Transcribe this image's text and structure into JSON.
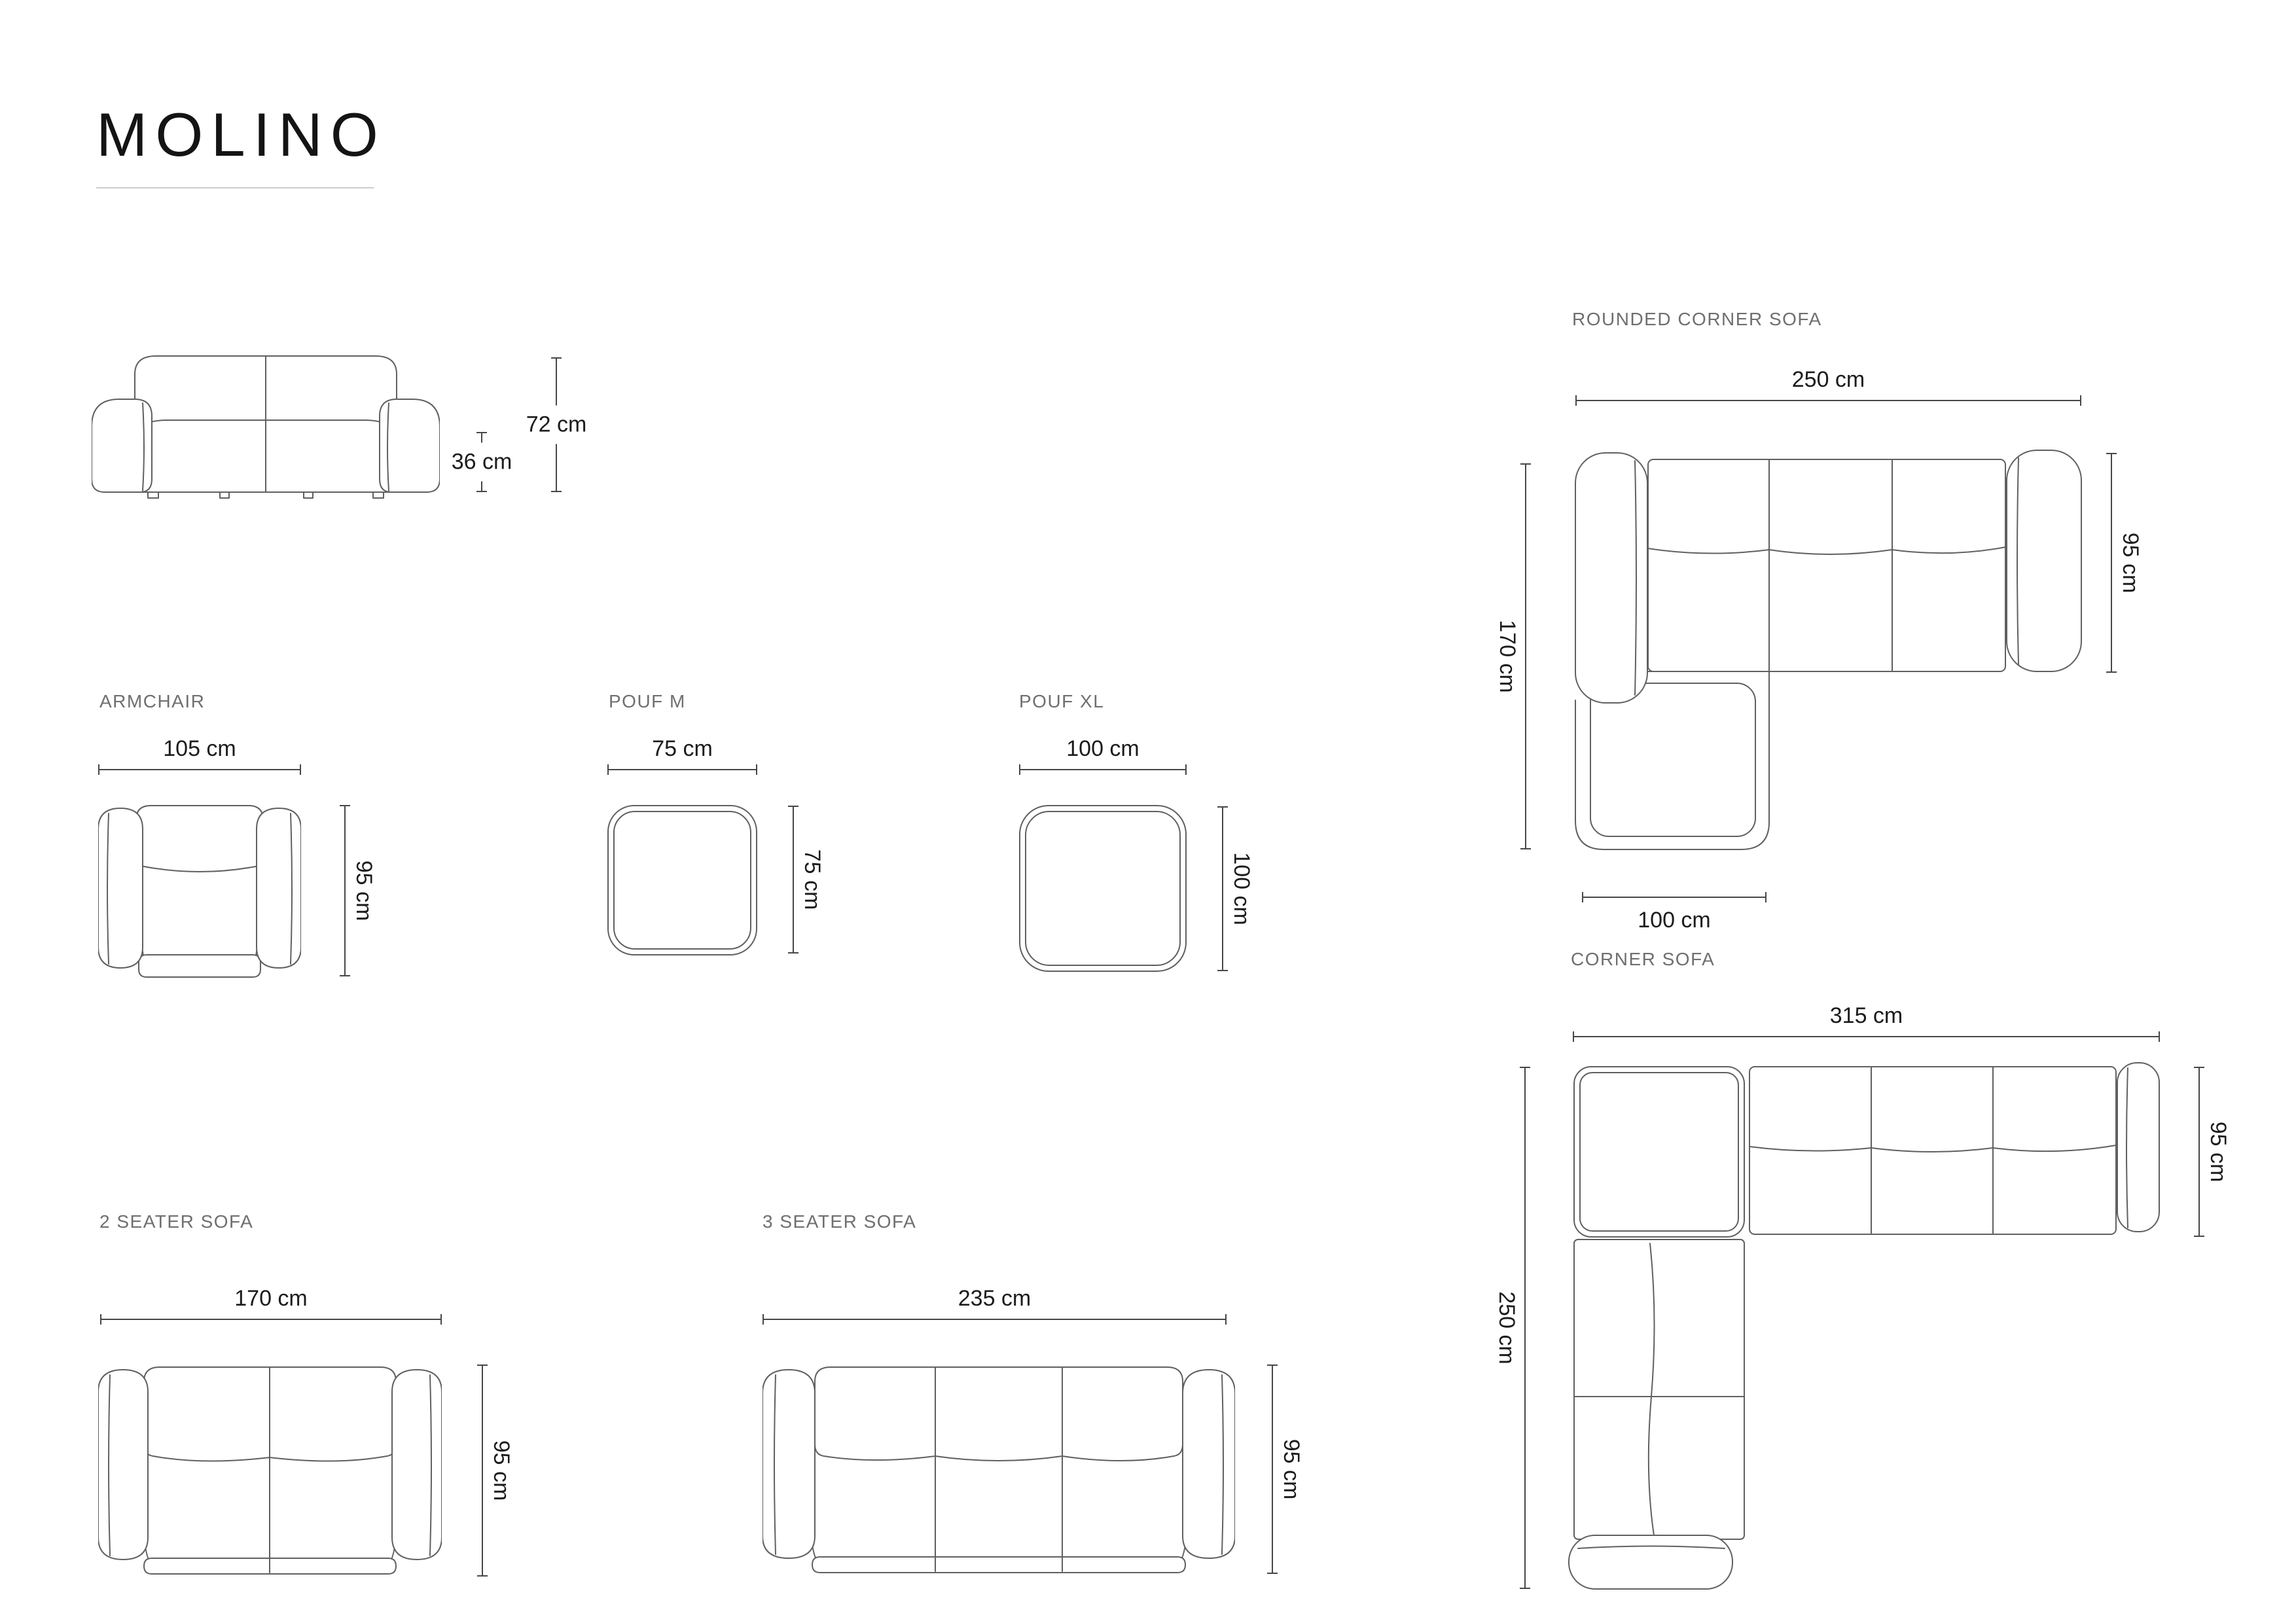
{
  "title": "MOLINO",
  "front_view": {
    "total_height": "72 cm",
    "seat_height": "36 cm"
  },
  "rounded_corner_sofa": {
    "label": "ROUNDED CORNER SOFA",
    "width": "250 cm",
    "depth": "95 cm",
    "side_length": "170 cm",
    "chaise_width": "100 cm"
  },
  "armchair": {
    "label": "ARMCHAIR",
    "width": "105 cm",
    "depth": "95 cm"
  },
  "pouf_m": {
    "label": "POUF M",
    "width": "75 cm",
    "depth": "75 cm"
  },
  "pouf_xl": {
    "label": "POUF XL",
    "width": "100 cm",
    "depth": "100 cm"
  },
  "corner_sofa": {
    "label": "CORNER SOFA",
    "width": "315 cm",
    "depth": "95 cm",
    "side_length": "250 cm"
  },
  "two_seater": {
    "label": "2 SEATER SOFA",
    "width": "170 cm",
    "depth": "95 cm"
  },
  "three_seater": {
    "label": "3 SEATER SOFA",
    "width": "235 cm",
    "depth": "95 cm"
  },
  "colors": {
    "line": "#606060",
    "dim_line": "#474747",
    "dim_text": "#1c1c1c",
    "label_text": "#6f6f6f",
    "title_text": "#141414",
    "rule": "#cccccc",
    "bg": "#ffffff"
  }
}
